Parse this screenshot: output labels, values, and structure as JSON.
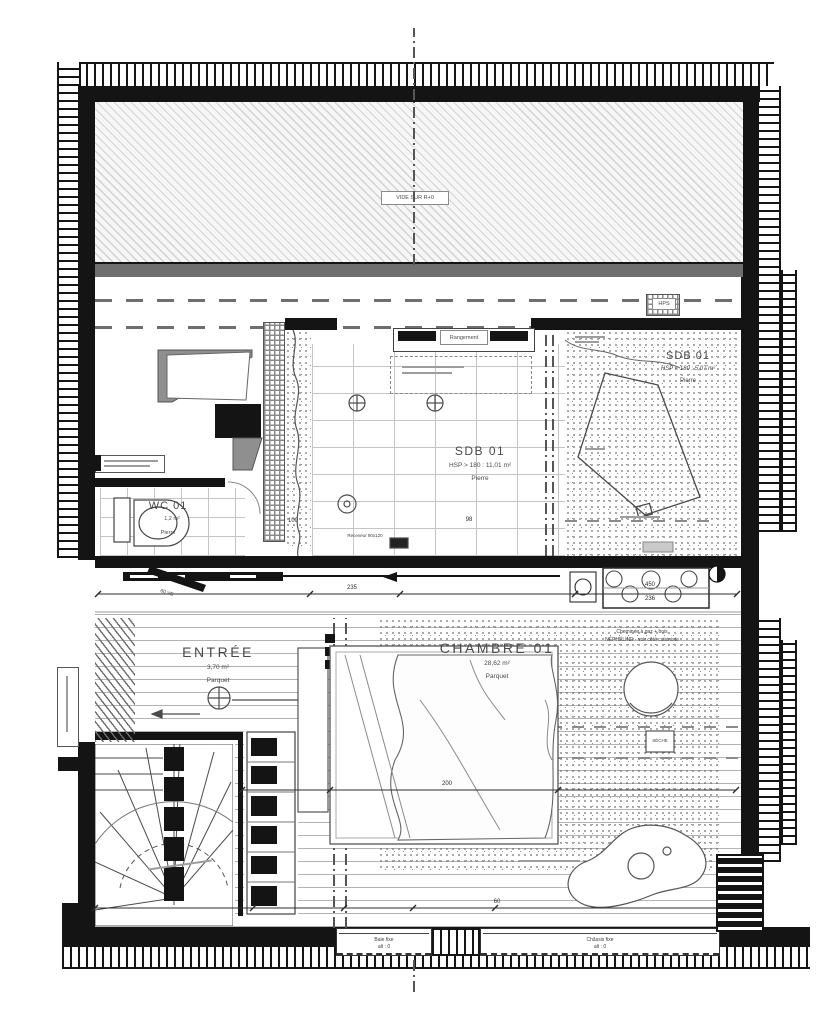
{
  "plan": {
    "void_label": "VIDE SUR R+0",
    "hps_label": "HPS",
    "rangement_label": "Rangement",
    "receveur_label": "Receveur 90x120",
    "door_label": "60 VB",
    "seche_label": "SÈCHE",
    "fireplace_note_line1": "Cheminée à gaz + bois",
    "fireplace_note_line2": "NÉPHÉLINE - voir côté cuisiniste",
    "rooms": {
      "wc": {
        "name": "WC 01",
        "area": "1,2 m²",
        "floor": "Pierre"
      },
      "sdb_main": {
        "name": "SDB 01",
        "height_area": "HSP > 180 : 11,01 m²",
        "floor": "Pierre"
      },
      "sdb_low": {
        "name": "SDB 01",
        "height_area": "HSP < 180 : 5,07 m²",
        "floor": "Pierre"
      },
      "entree": {
        "name": "ENTRÉE",
        "area": "3,70 m²",
        "floor": "Parquet"
      },
      "chambre": {
        "name": "CHAMBRE 01",
        "area": "28,62 m²",
        "floor": "Parquet"
      }
    },
    "dimensions": {
      "d100": "100",
      "d98": "98",
      "d235": "235",
      "d450": "450",
      "d236": "236",
      "d200": "200",
      "d60": "60"
    },
    "windows": {
      "left": {
        "line1": "Baie fixe",
        "line2": "alt : 0"
      },
      "right": {
        "line1": "Châssis fixe",
        "line2": "alt : 0"
      }
    },
    "colors": {
      "wall": "#141414",
      "line": "#4a4a4a",
      "text": "#3f3f3f"
    }
  }
}
